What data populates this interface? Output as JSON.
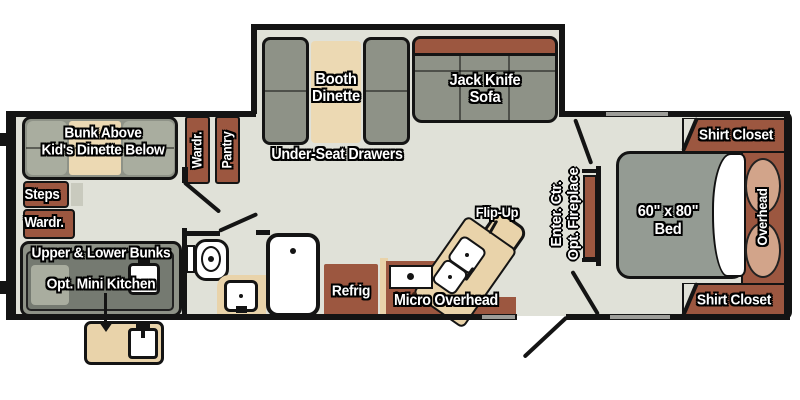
{
  "plan": {
    "bunkhouse": {
      "bunk_line1": "Bunk Above",
      "bunk_line2": "Kid's Dinette Below",
      "steps": "Steps",
      "wardrobe": "Wardr.",
      "bunks_line1": "Upper & Lower Bunks",
      "bunks_line2": "Opt. Mini Kitchen"
    },
    "hallway": {
      "wardrobe": "Wardr.",
      "pantry": "Pantry"
    },
    "living": {
      "booth_line1": "Booth",
      "booth_line2": "Dinette",
      "under_seat": "Under-Seat Drawers",
      "sofa_line1": "Jack Knife",
      "sofa_line2": "Sofa"
    },
    "kitchen": {
      "flip_up": "Flip-Up",
      "refrigerator": "Refrig",
      "micro": "Micro Overhead"
    },
    "entertainment": {
      "line1": "Enter. Ctr.",
      "line2": "Opt. Fireplace"
    },
    "bedroom": {
      "bed_line1": "60\" x 80\"",
      "bed_line2": "Bed",
      "overhead": "Overhead",
      "shirt_closet": "Shirt Closet"
    }
  },
  "colors": {
    "floor": "#e0e1d8",
    "wall": "#141414",
    "cabinet": "#9c5740",
    "cushion": "#8e9287",
    "cushion-light": "#a9ad9f",
    "counter": "#e9d3aa",
    "table": "#ecd9b3",
    "pillow": "#d2a48a",
    "window": "#9d9d99",
    "bed": "#949b93",
    "inner-unit": "#757a71"
  }
}
